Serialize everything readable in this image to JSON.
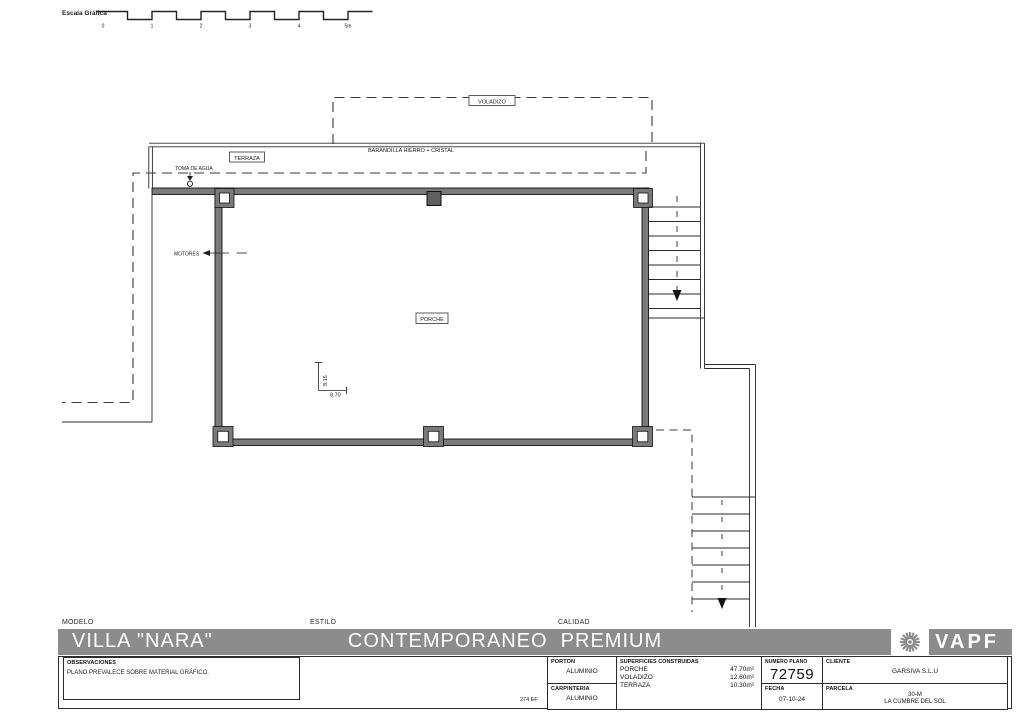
{
  "scale_bar": {
    "label": "Escala Gráfica",
    "ticks": [
      "0",
      "1",
      "2",
      "3",
      "4",
      "5m"
    ]
  },
  "plan": {
    "labels": {
      "voladizo": "VOLADIZO",
      "barandilla": "BARANDILLA HIERRO + CRISTAL",
      "terraza": "TERRAZA",
      "toma_de_agua": "TOMA DE AGUA",
      "motores": "MOTORES",
      "porche": "PORCHE",
      "dim_vertical": "8.15",
      "dim_horizontal": "8.70"
    }
  },
  "title_block": {
    "modelo_label": "MODELO",
    "modelo": "VILLA \"NARA\"",
    "estilo_label": "ESTILO",
    "estilo": "CONTEMPORANEO  PREMIUM",
    "calidad_label": "CALIDAD",
    "brand": "VAPF",
    "observaciones_label": "OBSERVACIONES",
    "observaciones": "PLANO PREVALECE SOBRE MATERIAL GRÁFICO.",
    "ref_code": "274 EF",
    "porton_label": "PORTON",
    "porton": "ALUMINIO",
    "carpinteria_label": "CARPINTERIA",
    "carpinteria": "ALUMINIO",
    "superficies_label": "SUPERFICIES CONSTRUIDAS",
    "superficies": [
      {
        "name": "PORCHE",
        "value": "47.70m²"
      },
      {
        "name": "VOLADIZO",
        "value": "12.60m²"
      },
      {
        "name": "TERRAZA",
        "value": "10.30m²"
      }
    ],
    "numero_plano_label": "NUMERO PLANO",
    "numero_plano": "72759",
    "fecha_label": "FECHA",
    "fecha": "07-10-24",
    "cliente_label": "CLIENTE",
    "cliente": "GARSIVA S.L.U",
    "parcela_label": "PARCELA",
    "parcela": "30-M",
    "parcela_location": "LA CUMBRE DEL SOL"
  },
  "colors": {
    "wall_fill": "#7a7a7a",
    "band_bg": "#8c8c8c",
    "line": "#2a2a2a"
  }
}
